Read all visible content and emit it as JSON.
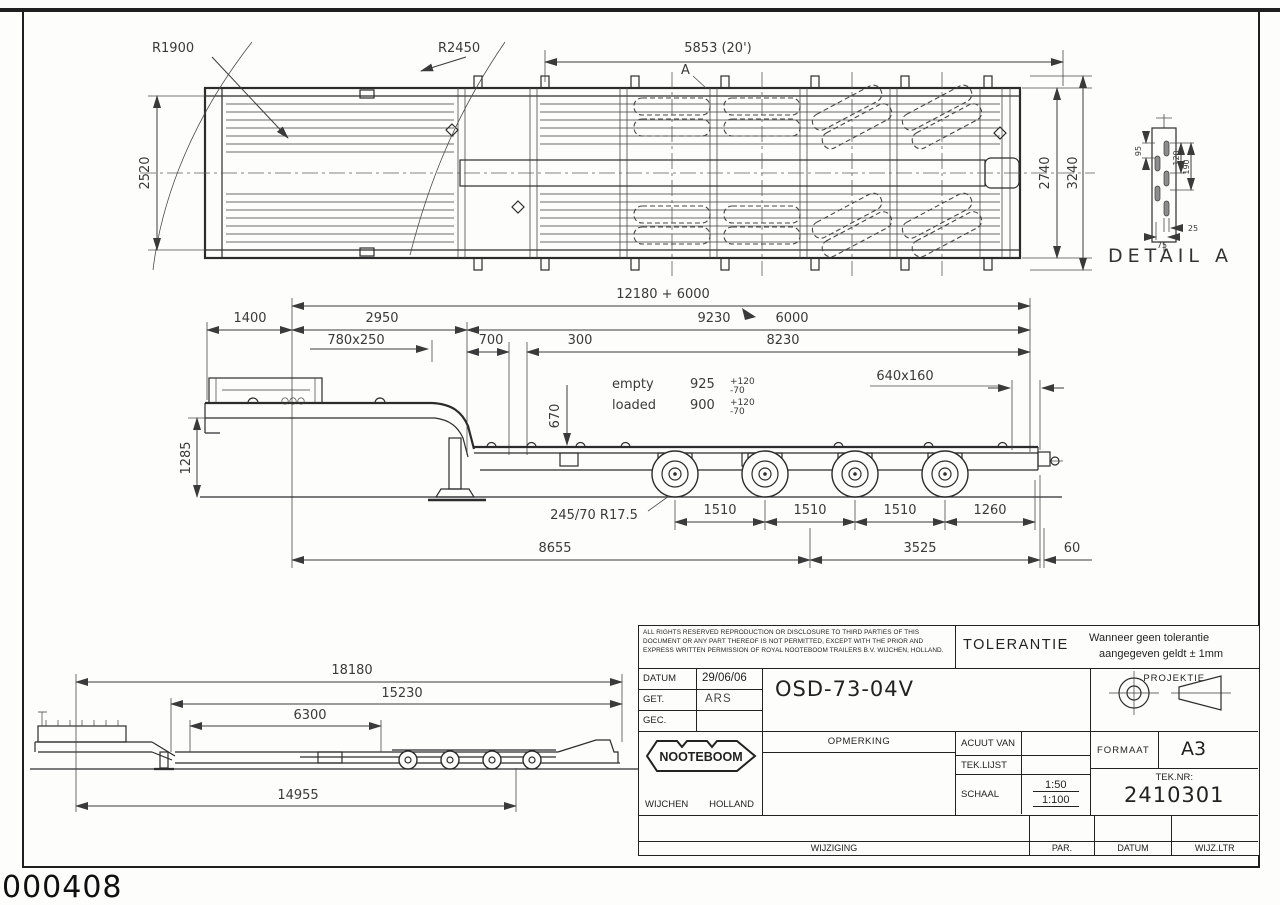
{
  "frame": {
    "page_code": "000408"
  },
  "top_view": {
    "r1": "R1900",
    "r2": "R2450",
    "len_top": "5853 (20')",
    "detail_ref": "A",
    "width_2520": "2520",
    "width_2740": "2740",
    "width_3240": "3240"
  },
  "dims_mid": {
    "total": "12180 + 6000",
    "d1400": "1400",
    "d2950": "2950",
    "d9230": "9230",
    "d6000": "6000",
    "d780x250": "780x250",
    "d700": "700",
    "d300": "300",
    "d8230": "8230"
  },
  "side_view": {
    "h1285": "1285",
    "h670": "670",
    "empty_label": "empty",
    "empty_value": "925",
    "loaded_label": "loaded",
    "loaded_value": "900",
    "tol_plus": "+120",
    "tol_minus": "-70",
    "beam": "640x160",
    "tyre": "245/70 R17.5",
    "ax1": "1510",
    "ax2": "1510",
    "ax3": "1510",
    "ax4": "1260",
    "d8655": "8655",
    "d3525": "3525",
    "d60": "60"
  },
  "bottom_view": {
    "d18180": "18180",
    "d15230": "15230",
    "d6300": "6300",
    "d14955": "14955"
  },
  "detail_a": {
    "title": "DETAIL A",
    "d95": "95",
    "d120": "120",
    "d190": "190",
    "d25": "25",
    "d75": "75"
  },
  "title_block": {
    "legal_1": "ALL RIGHTS RESERVED REPRODUCTION OR DISCLOSURE TO THIRD PARTIES OF THIS",
    "legal_2": "DOCUMENT OR ANY PART THEREOF IS NOT PERMITTED, EXCEPT WITH THE PRIOR AND",
    "legal_3": "EXPRESS WRITTEN PERMISSION OF ROYAL NOOTEBOOM TRAILERS B.V. WIJCHEN, HOLLAND.",
    "tolerantie_label": "TOLERANTIE",
    "tolerantie_1": "Wanneer geen tolerantie",
    "tolerantie_2": "aangegeven geldt ± 1mm",
    "datum_label": "DATUM",
    "datum_value": "29/06/06",
    "get_label": "GET.",
    "get_value": "ARS",
    "gec_label": "GEC.",
    "gec_value": "",
    "drawing_number": "OSD-73-04V",
    "projektie_label": "PROJEKTIE",
    "opmerking_label": "OPMERKING",
    "acuut_label": "ACUUT VAN",
    "teklijst_label": "TEK.LIJST",
    "schaal_label": "SCHAAL",
    "schaal_1": "1:50",
    "schaal_2": "1:100",
    "formaat_label": "FORMAAT",
    "formaat_value": "A3",
    "teknr_label": "TEK.NR:",
    "teknr_value": "2410301",
    "brand": "NOOTEBOOM",
    "city": "WIJCHEN",
    "country": "HOLLAND",
    "wijziging_label": "WIJZIGING",
    "par_label": "PAR.",
    "datum2_label": "DATUM",
    "wijzltr_label": "WIJZ.LTR"
  }
}
